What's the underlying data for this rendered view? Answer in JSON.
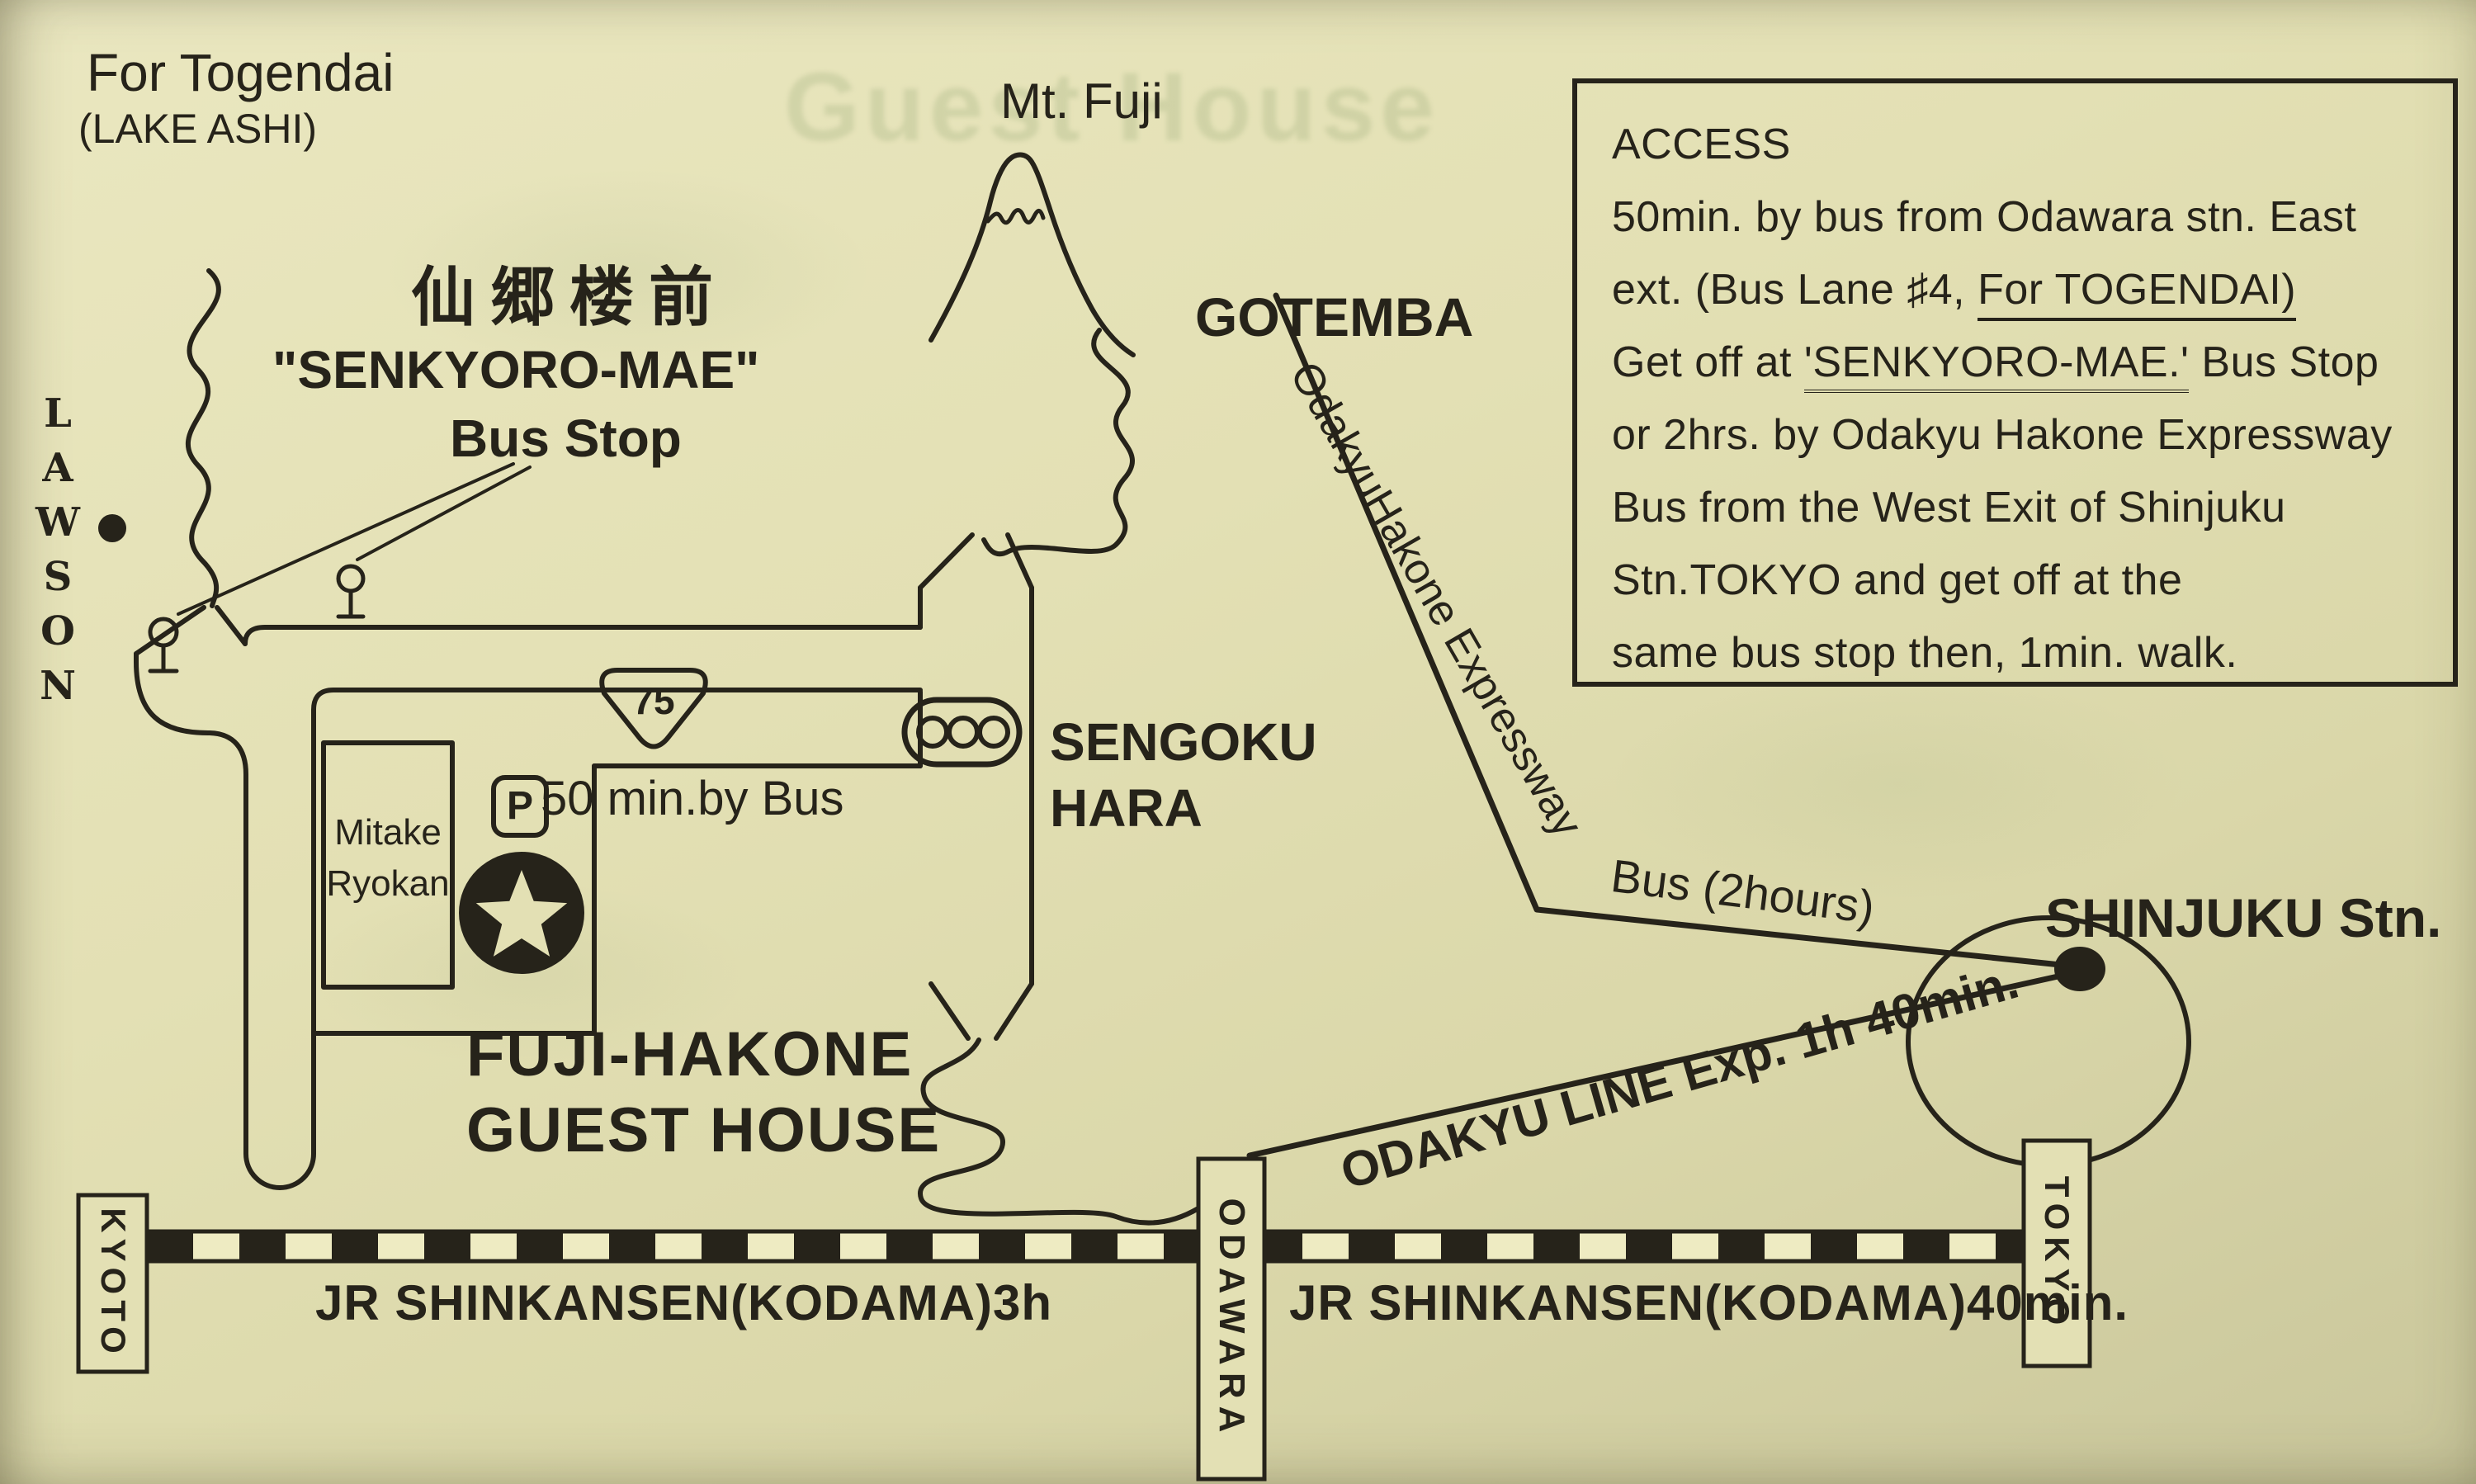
{
  "colors": {
    "paper": "#e3e0b4",
    "ink": "#26231a",
    "ghost_green": "#7d965f"
  },
  "map": {
    "ghost_bleed_text": "Guest House",
    "labels": {
      "togendai_line1": "For Togendai",
      "togendai_line2": "(LAKE ASHI)",
      "lawson": "LAWSON",
      "senkyoro_kanji": "仙郷楼前",
      "senkyoro_romaji": "\"SENKYORO-MAE\"",
      "senkyoro_busstop": "Bus Stop",
      "mt_fuji": "Mt. Fuji",
      "gotemba": "GOTEMBA",
      "route_number": "75",
      "sengoku_line1": "SENGOKU",
      "sengoku_line2": "HARA",
      "mitake_line1": "Mitake",
      "mitake_line2": "Ryokan",
      "parking": "P",
      "guesthouse_line1": "FUJI-HAKONE",
      "guesthouse_line2": "GUEST HOUSE",
      "bus_50min": "50 min.by Bus",
      "expressway": "OdakyuHakone Expressway",
      "expressway_bus": "Bus (2hours)",
      "shinjuku": "SHINJUKU Stn.",
      "odakyu_line": "ODAKYU LINE Exp. 1h 40min.",
      "kyoto": "KYOTO",
      "odawara": "ODAWARA",
      "tokyo": "TOKYO",
      "jr_left": "JR SHINKANSEN(KODAMA)3h",
      "jr_right": "JR SHINKANSEN(KODAMA)40min."
    },
    "access": {
      "lines": [
        [
          {
            "t": "ACCESS"
          }
        ],
        [
          {
            "t": "50min. by bus from Odawara stn. East"
          }
        ],
        [
          {
            "t": "ext. (Bus Lane ♯4, "
          },
          {
            "t": "For TOGENDAI)",
            "u": 1
          }
        ],
        [
          {
            "t": "Get off at "
          },
          {
            "t": "'SENKYORO-MAE.'",
            "uu": 1
          },
          {
            "t": " Bus Stop"
          }
        ],
        [
          {
            "t": "or 2hrs. by Odakyu Hakone Expressway"
          }
        ],
        [
          {
            "t": "Bus from the West Exit of Shinjuku"
          }
        ],
        [
          {
            "t": "Stn.TOKYO and get off at the"
          }
        ],
        [
          {
            "t": "same bus stop then, 1min. walk."
          }
        ]
      ]
    }
  }
}
